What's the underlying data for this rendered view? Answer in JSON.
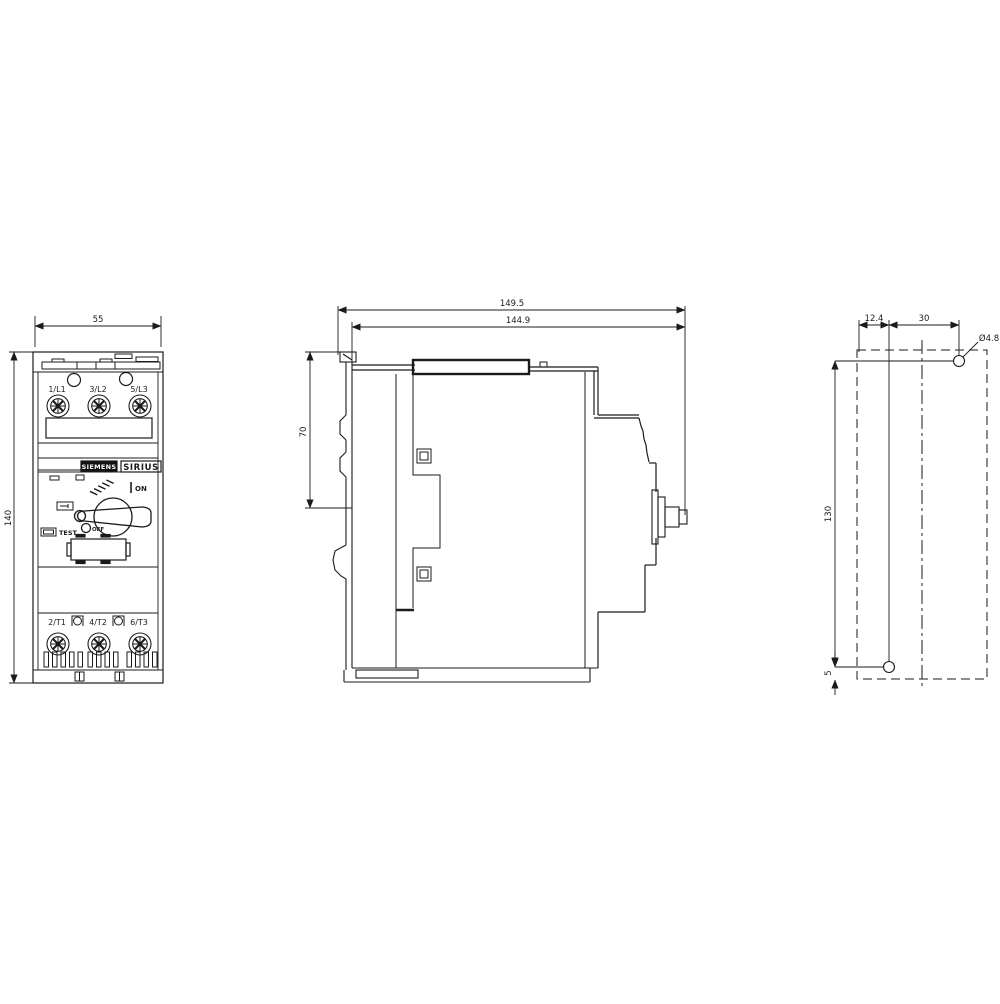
{
  "front_view": {
    "width_dim": "55",
    "height_dim": "140",
    "brand": "SIEMENS",
    "product_line": "SIRIUS",
    "top_terminals": [
      "1/L1",
      "3/L2",
      "5/L3"
    ],
    "bottom_terminals": [
      "2/T1",
      "4/T2",
      "6/T3"
    ],
    "switch_on_label": "ON",
    "switch_off_label": "OFF",
    "test_button_label": "TEST"
  },
  "side_view": {
    "overall_depth_dim": "149.5",
    "depth_dim": "144.9",
    "upper_height_dim": "70"
  },
  "drill_plan": {
    "edge_offset_dim": "12.4",
    "hole_spacing_horizontal_dim": "30",
    "hole_diameter_dim": "Ø4.8",
    "hole_spacing_vertical_dim": "130",
    "bottom_offset_dim": "5"
  },
  "colors": {
    "line": "#1b1b1b",
    "background": "#ffffff",
    "brand_box": "#111111"
  }
}
